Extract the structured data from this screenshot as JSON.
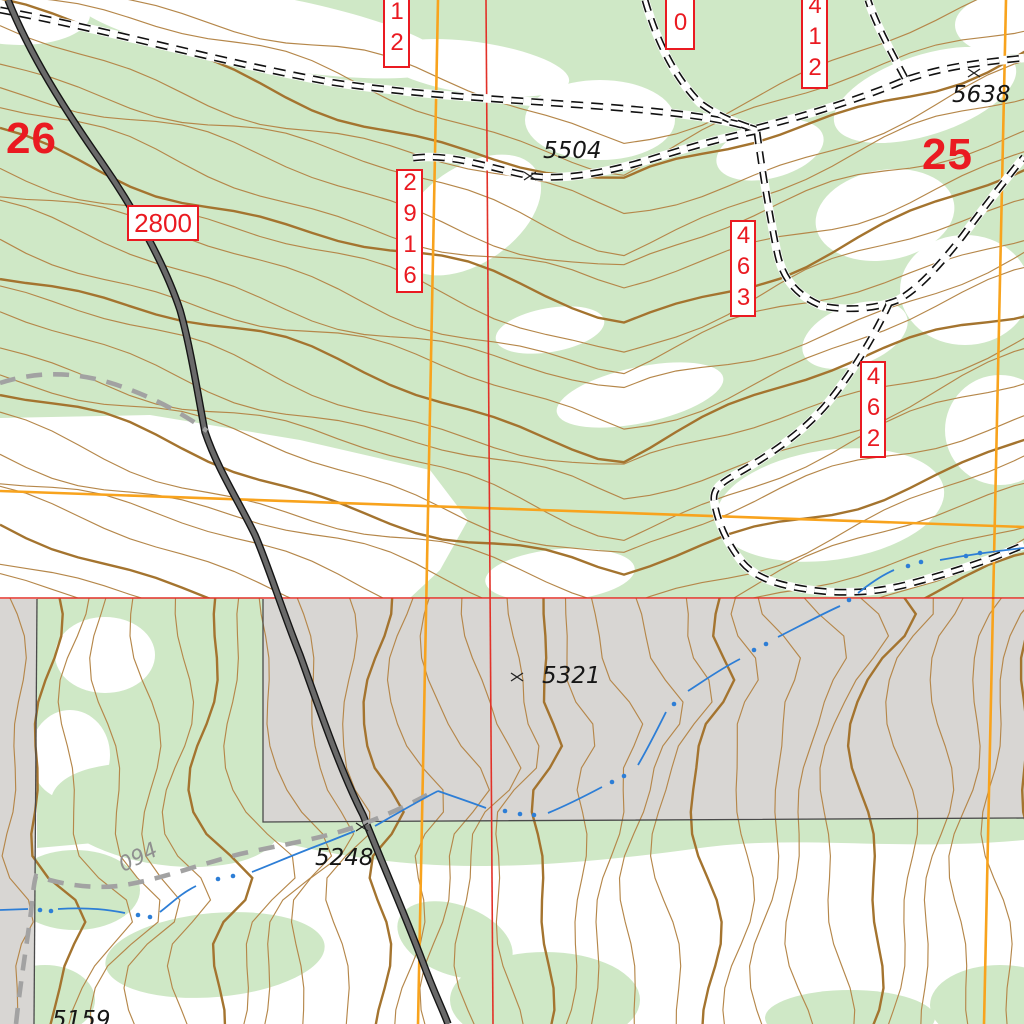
{
  "sections": [
    {
      "number": "26"
    },
    {
      "number": "25"
    }
  ],
  "road_number_labels": [
    {
      "text": "2800",
      "orientation": "horizontal"
    },
    {
      "text": "2916",
      "orientation": "vertical"
    },
    {
      "text": "12",
      "orientation": "vertical",
      "note": "clipped at top edge"
    },
    {
      "text": "00",
      "orientation": "vertical",
      "note": "clipped at top edge"
    },
    {
      "text": "412",
      "orientation": "vertical"
    },
    {
      "text": "463",
      "orientation": "vertical"
    },
    {
      "text": "462",
      "orientation": "vertical"
    }
  ],
  "spot_elevations": [
    {
      "value": "5504"
    },
    {
      "value": "5638"
    },
    {
      "value": "5321"
    },
    {
      "value": "5248"
    },
    {
      "value": "5159"
    }
  ],
  "trail_label": {
    "text": "094"
  },
  "colors": {
    "forest_green": "#cfe8c6",
    "terrain_gray": "#d8d6d3",
    "contour_brown": "#b5874a",
    "index_contour_brown": "#a4742f",
    "grid_orange": "#f8a31d",
    "grid_red": "#e23128",
    "label_red": "#ea1a21",
    "stream_blue": "#2d7ed6",
    "road_gray": "#696969",
    "trail_gray": "#a2a2a2"
  }
}
